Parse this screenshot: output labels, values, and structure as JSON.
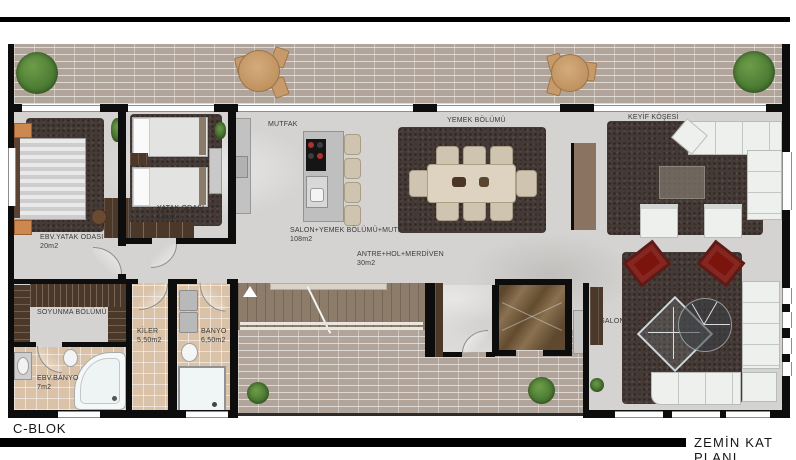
{
  "footer": {
    "block_label": "C-BLOK",
    "plan_label": "ZEMİN KAT PLANI"
  },
  "rooms": {
    "kitchen": {
      "label": "MUTFAK"
    },
    "dining": {
      "label": "YEMEK BÖLÜMÜ"
    },
    "pleasure_corner": {
      "label": "KEYİF KÖŞESİ"
    },
    "open_living": {
      "label": "SALON+YEMEK BÖLÜMÜ+MUTFAK",
      "area": "108m2"
    },
    "hall": {
      "label": "ANTRE+HOL+MERDİVEN",
      "area": "30m2"
    },
    "salon": {
      "label": "SALON"
    },
    "master_bedroom": {
      "label": "EBV.YATAK ODASI",
      "area": "20m2"
    },
    "bedroom": {
      "label": "YATAK ODASI",
      "area": "13m2"
    },
    "dressing": {
      "label": "SOYUNMA BÖLÜMÜ"
    },
    "master_bath": {
      "label": "EBV.BANYO",
      "area": "7m2"
    },
    "pantry": {
      "label": "KİLER",
      "area": "5,50m2"
    },
    "bathroom": {
      "label": "BANYO",
      "area": "6,50m2"
    }
  },
  "colors": {
    "wall": "#0d0d0d",
    "brick": "#b1a59b",
    "marble": "#d4d3d1",
    "rug": "#453a36",
    "tile": "#d9c2a8",
    "wood": "#4b3829",
    "accent-red": "#7c140e",
    "greenery": "#55823a"
  }
}
